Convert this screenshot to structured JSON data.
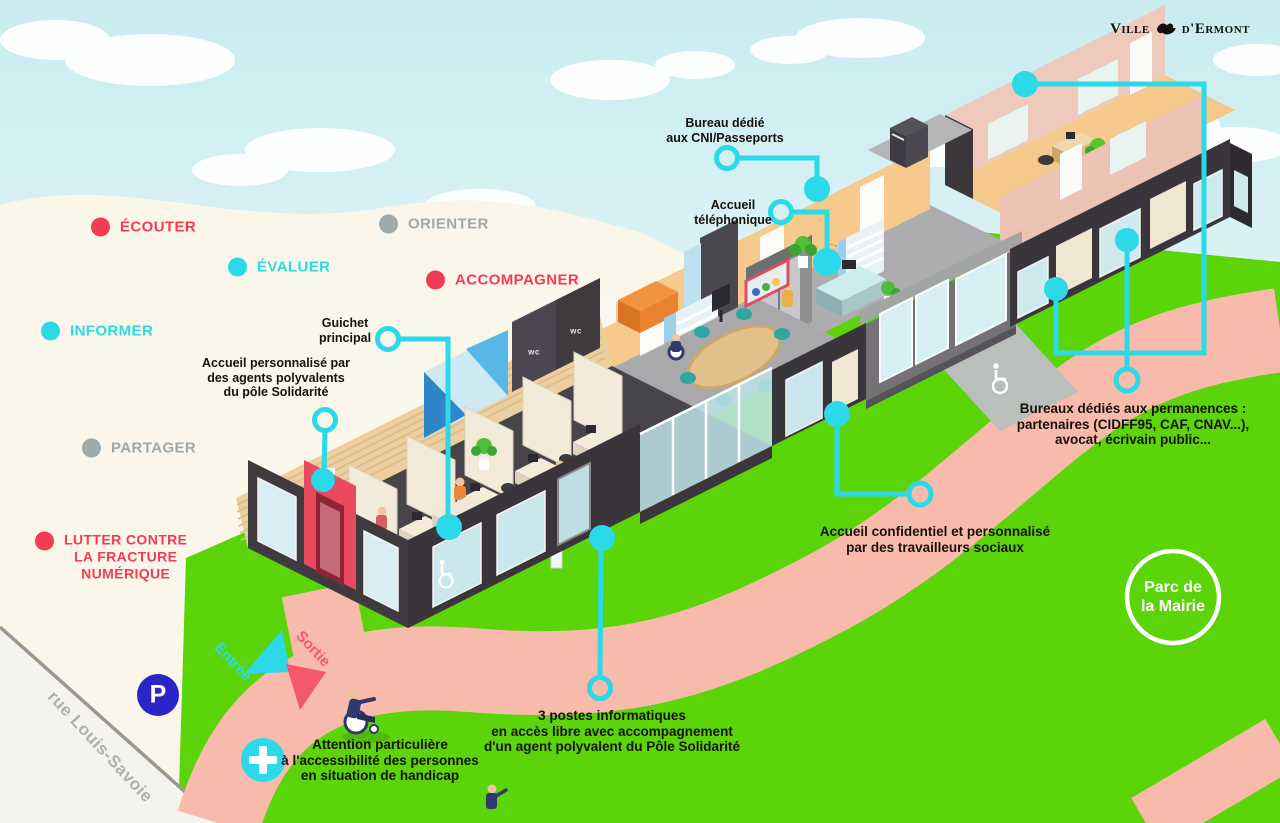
{
  "palette": {
    "cyan": "#2BD9E8",
    "red": "#F23C55",
    "keyword-gray": "#9EA9A9",
    "parking-blue": "#2B25C8",
    "grass-green": "#5BD50A",
    "path-salmon": "#F8BAAA",
    "street-gray": "#A8B4AC",
    "label-black": "#17110B"
  },
  "logo": {
    "ville": "Ville",
    "ermont": "d'Ermont"
  },
  "keywords": [
    {
      "label": "ÉCOUTER",
      "color": "#F23C55"
    },
    {
      "label": "ÉVALUER",
      "color": "#2BD9E8"
    },
    {
      "label": "INFORMER",
      "color": "#2BD9E8"
    },
    {
      "label": "ORIENTER",
      "color": "#9EA9A9"
    },
    {
      "label": "ACCOMPAGNER",
      "color": "#F23C55"
    },
    {
      "label": "PARTAGER",
      "color": "#9EA9A9"
    },
    {
      "lines": [
        "LUTTER CONTRE",
        "LA FRACTURE",
        "NUMÉRIQUE"
      ],
      "color": "#F23C55"
    }
  ],
  "annotations": {
    "cni": {
      "lines": [
        "Bureau dédié",
        "aux CNI/Passeports"
      ]
    },
    "telephone": {
      "lines": [
        "Accueil",
        "téléphonique"
      ]
    },
    "guichet": {
      "lines": [
        "Guichet",
        "principal"
      ]
    },
    "accueil_perso": {
      "lines": [
        "Accueil personnalisé par",
        "des agents polyvalents",
        "du pôle Solidarité"
      ]
    },
    "permanences": {
      "lines": [
        "Bureaux dédiés aux permanences :",
        "partenaires (CIDFF95, CAF, CNAV...),",
        "avocat, écrivain public..."
      ]
    },
    "confidentiel": {
      "lines": [
        "Accueil confidentiel et personnalisé",
        "par des travailleurs sociaux"
      ]
    },
    "postes": {
      "lines": [
        "3 postes informatiques",
        "en accès libre avec accompagnement",
        "d'un agent polyvalent du Pôle Solidarité"
      ]
    },
    "handicap": {
      "lines": [
        "Attention particulière",
        "à l'accessibilité des personnes",
        "en situation de handicap"
      ]
    }
  },
  "map": {
    "parc": {
      "lines": [
        "Parc de",
        "la Mairie"
      ]
    },
    "street": "rue Louis-Savoie",
    "parking": "P",
    "entree": "Entrée",
    "sortie": "Sortie",
    "wc": "wc"
  }
}
